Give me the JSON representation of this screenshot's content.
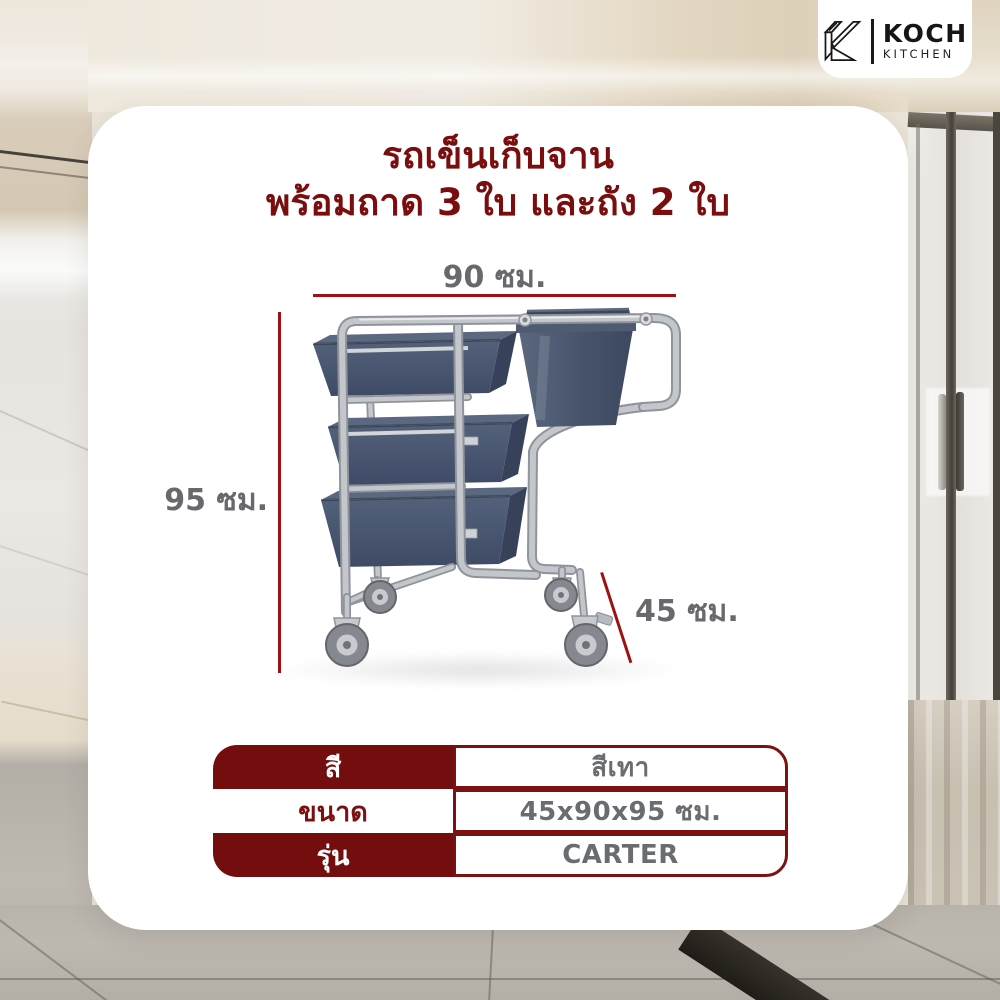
{
  "brand": {
    "name": "KOCH",
    "subname": "KITCHEN"
  },
  "title": {
    "line1": "รถเข็นเก็บจาน",
    "line2": "พร้อมถาด 3 ใบ และถัง 2 ใบ"
  },
  "product": {
    "alt": "รถเข็นสแตนเลสเก็บจาน พร้อมถาดสีเทา 3 ใบ และถังสีเทา 2 ใบ ล้อเลื่อน 4 ล้อ"
  },
  "dimensions": {
    "width": "90 ซม.",
    "height": "95 ซม.",
    "depth": "45 ซม."
  },
  "spec_table": {
    "rows": [
      {
        "label": "สี",
        "value": "สีเทา"
      },
      {
        "label": "ขนาด",
        "value": "45x90x95 ซม."
      },
      {
        "label": "รุ่น",
        "value": "CARTER"
      }
    ]
  },
  "colors": {
    "maroon": "#740d0d",
    "title_maroon": "#7a0d0d",
    "dimension_line_red": "#9d1112",
    "text_gray": "#6a6d70",
    "tray_slate": "#4b5870",
    "steel": "#c3c7cc",
    "card_white": "#ffffff"
  }
}
